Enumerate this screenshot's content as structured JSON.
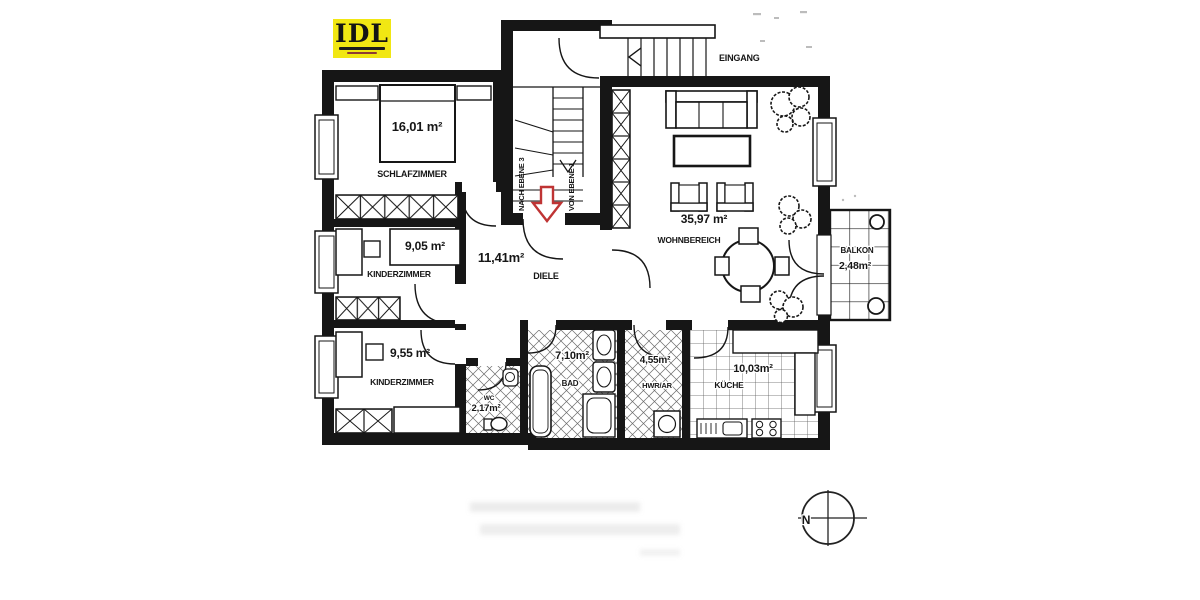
{
  "logo": {
    "text": "IDL"
  },
  "rooms": [
    {
      "id": "schlafzimmer",
      "name": "SCHLAFZIMMER",
      "area": "16,01 m²"
    },
    {
      "id": "kinderzimmer-oben",
      "name": "KINDERZIMMER",
      "area": "9,05 m²"
    },
    {
      "id": "kinderzimmer-unten",
      "name": "KINDERZIMMER",
      "area": "9,55 m²"
    },
    {
      "id": "diele",
      "name": "DIELE",
      "area": "11,41m²"
    },
    {
      "id": "wohnbereich",
      "name": "WOHNBEREICH",
      "area": "35,97 m²"
    },
    {
      "id": "bad",
      "name": "BAD",
      "area": "7,10m²"
    },
    {
      "id": "wc",
      "name": "WC",
      "area": "2,17m²"
    },
    {
      "id": "hwr",
      "name": "HWR/AR",
      "area": "4,55m²"
    },
    {
      "id": "kueche",
      "name": "KÜCHE",
      "area": "10,03m²"
    },
    {
      "id": "balkon",
      "name": "BALKON",
      "area": "2,48m²"
    }
  ],
  "labels": {
    "eingang": "EINGANG",
    "stairs_up": "NACH EBENE 3",
    "stairs_down": "VON EBENE 1",
    "compass_north": "N"
  },
  "colors": {
    "wall": "#161616",
    "arrow_red": "#bf3434",
    "logo_yellow": "#f1e713",
    "paper": "#ffffff"
  }
}
